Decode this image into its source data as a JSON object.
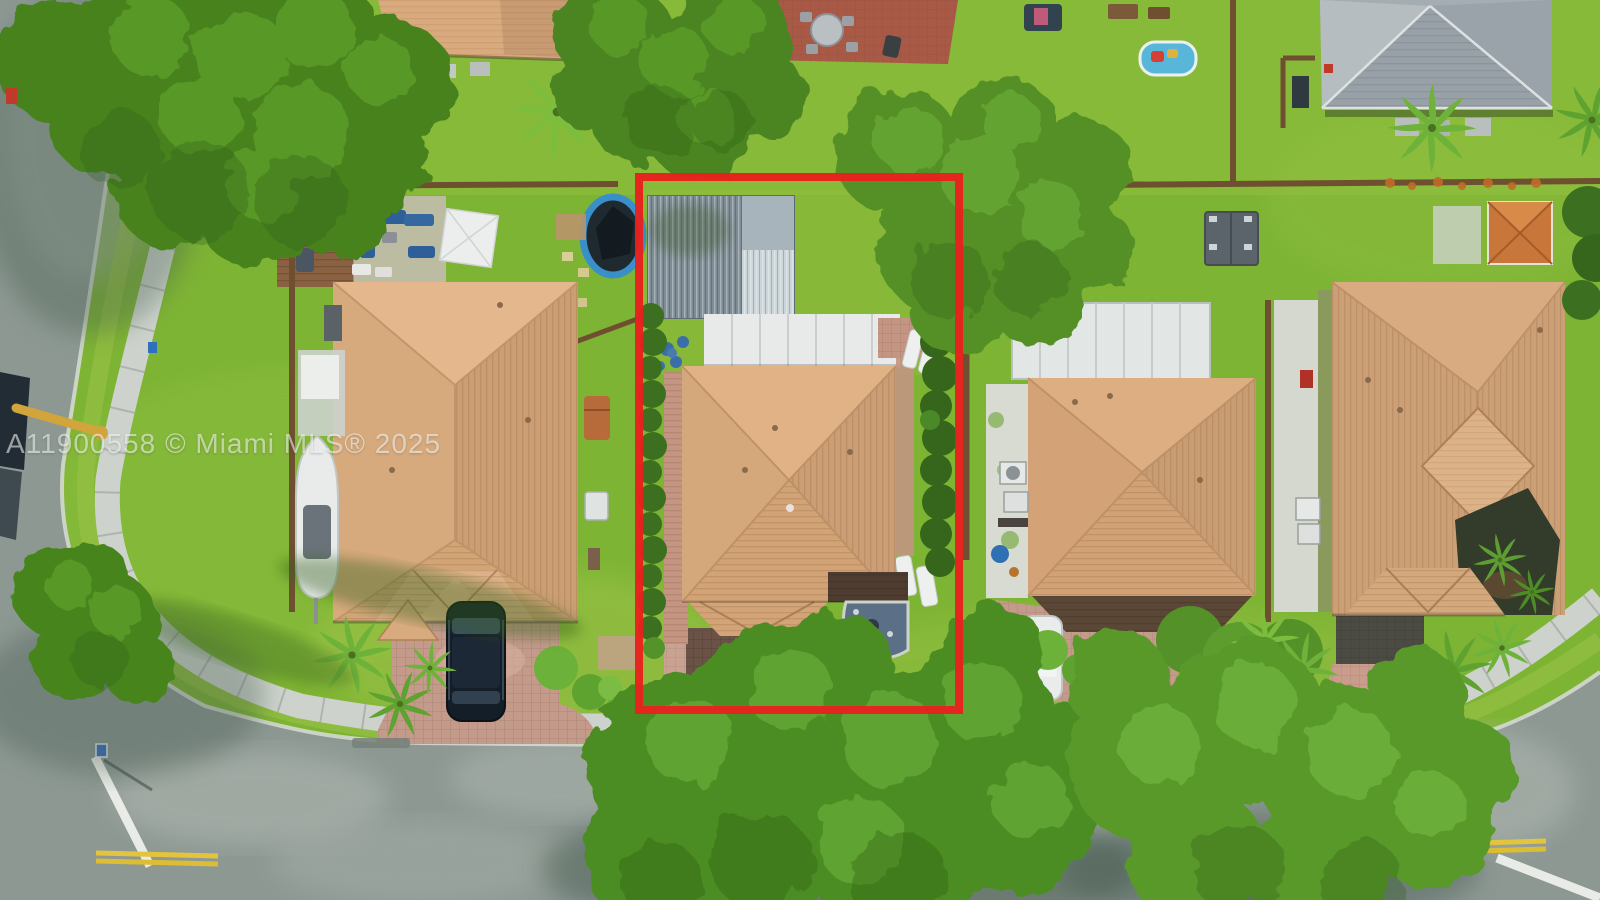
{
  "meta": {
    "type": "aerial-drone-photo",
    "subject": "residential lot outlined in red in a suburban block",
    "width_px": 1600,
    "height_px": 900
  },
  "watermark": {
    "text": "A11900558 © Miami MLS® 2025",
    "color_hex": "#ffffff",
    "opacity": 0.55
  },
  "highlight_box": {
    "purpose": "subject property boundary",
    "color_hex": "#e8201d",
    "x": 639,
    "y": 177,
    "width": 320,
    "height": 533,
    "stroke_px": 8
  },
  "palette": {
    "grass": "#7eb434",
    "grass_light": "#9ac247",
    "asphalt": "#8d9893",
    "asphalt_shadow": "#43584b",
    "sidewalk": "#cdd3cc",
    "roof_tan": "#d5a87b",
    "roof_gray": "#a4adb2",
    "canopy_white": "#e7eae9",
    "shed_metal": "#7e8c95",
    "pool_water": "#1e2a30",
    "pool_ring": "#3a8fc8",
    "fence_brown": "#6e4f30",
    "marking_yellow": "#e3c43c",
    "marking_white": "#f2f4f0"
  },
  "scene": {
    "objects": [
      "subject house with tan tile hip roof",
      "metal storage shed in subject backyard",
      "white canopy awning",
      "dark paver driveway with rock garden",
      "hedge rows along subject lot lines",
      "left neighbor house with boat and black SUV",
      "middle neighbor house with white flat roof and white car",
      "right neighbor house with interior palm courtyard",
      "gray hip-roof house top right",
      "round above-ground pool",
      "inflatable kiddie pool",
      "backyard wood deck with blue patio furniture and white umbrella",
      "brick patio with round table",
      "orange gazebo and gray garden shed",
      "curved corner street with sidewalks",
      "white stop bars and yellow center lines",
      "green trash bin",
      "utility truck with yellow boom",
      "street lamp and street signs",
      "large shade trees and palm trees"
    ]
  }
}
